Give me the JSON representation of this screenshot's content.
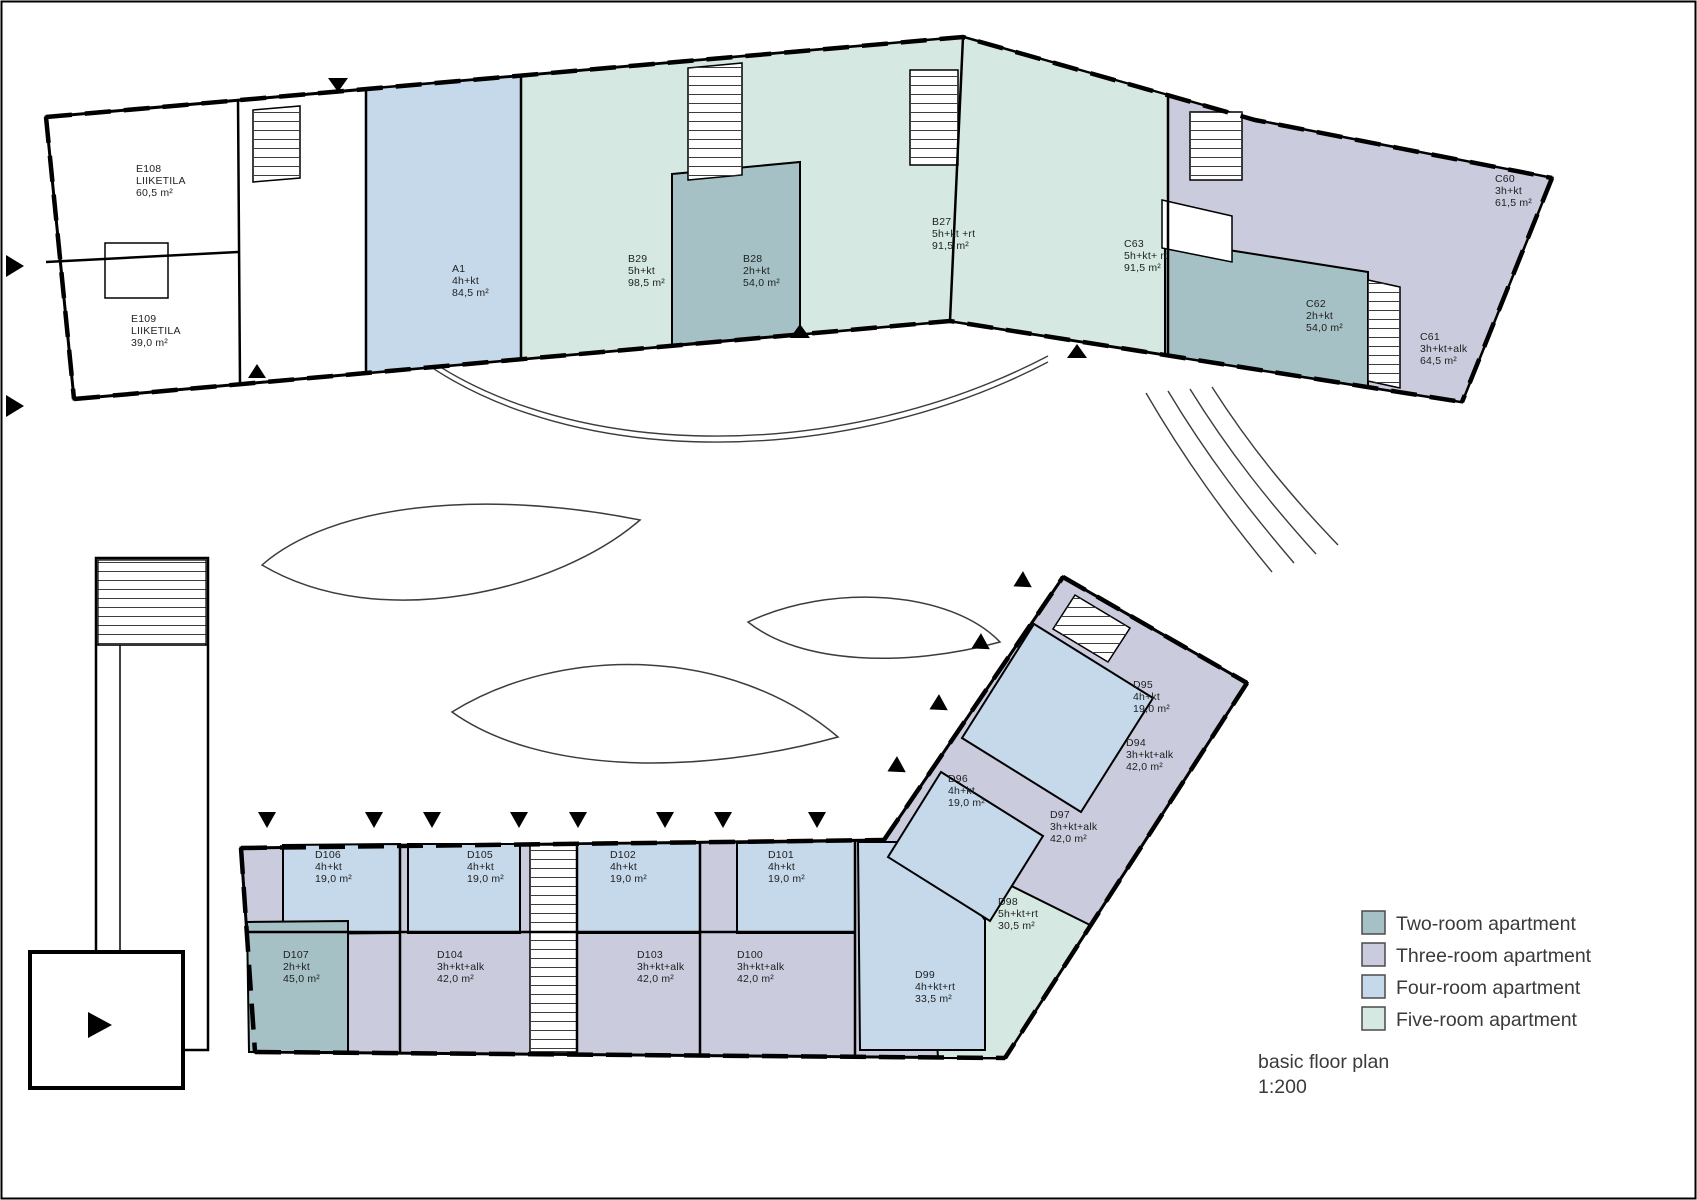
{
  "page": {
    "title_line1": "basic floor plan",
    "title_line2": "1:200"
  },
  "colors": {
    "wall": "#000000",
    "thin_line": "#3c3c3c",
    "white": "#ffffff",
    "two_room": "#a6c1c5",
    "three_room": "#cacbdc",
    "four_room": "#c5d9eb",
    "five_room": "#d5e8e2"
  },
  "legend": {
    "items": [
      {
        "label": "Two-room apartment",
        "color": "#a6c1c5"
      },
      {
        "label": "Three-room apartment",
        "color": "#cacbdc"
      },
      {
        "label": "Four-room apartment",
        "color": "#c5d9eb"
      },
      {
        "label": "Five-room apartment",
        "color": "#d5e8e2"
      }
    ]
  },
  "units": [
    {
      "id": "E108",
      "type": "LIIKETILA",
      "area": "60,5 m²",
      "category": "commercial"
    },
    {
      "id": "E109",
      "type": "LIIKETILA",
      "area": "39,0 m²",
      "category": "commercial"
    },
    {
      "id": "A1",
      "type": "4h+kt",
      "area": "84,5 m²",
      "category": "four_room"
    },
    {
      "id": "B29",
      "type": "5h+kt",
      "area": "98,5 m²",
      "category": "five_room"
    },
    {
      "id": "B28",
      "type": "2h+kt",
      "area": "54,0 m²",
      "category": "two_room"
    },
    {
      "id": "B27",
      "type": "5h+kt +rt",
      "area": "91,5 m²",
      "category": "five_room"
    },
    {
      "id": "C63",
      "type": "5h+kt+ rt",
      "area": "91,5 m²",
      "category": "five_room"
    },
    {
      "id": "C60",
      "type": "3h+kt",
      "area": "61,5 m²",
      "category": "three_room"
    },
    {
      "id": "C62",
      "type": "2h+kt",
      "area": "54,0 m²",
      "category": "two_room"
    },
    {
      "id": "C61",
      "type": "3h+kt+alk",
      "area": "64,5 m²",
      "category": "three_room"
    },
    {
      "id": "D95",
      "type": "4h+kt",
      "area": "19,0 m²",
      "category": "four_room"
    },
    {
      "id": "D94",
      "type": "3h+kt+alk",
      "area": "42,0 m²",
      "category": "three_room"
    },
    {
      "id": "D96",
      "type": "4h+kt",
      "area": "19,0 m²",
      "category": "four_room"
    },
    {
      "id": "D97",
      "type": "3h+kt+alk",
      "area": "42,0 m²",
      "category": "three_room"
    },
    {
      "id": "D98",
      "type": "5h+kt+rt",
      "area": "30,5 m²",
      "category": "five_room"
    },
    {
      "id": "D99",
      "type": "4h+kt+rt",
      "area": "33,5 m²",
      "category": "four_room"
    },
    {
      "id": "D100",
      "type": "3h+kt+alk",
      "area": "42,0 m²",
      "category": "three_room"
    },
    {
      "id": "D101",
      "type": "4h+kt",
      "area": "19,0 m²",
      "category": "four_room"
    },
    {
      "id": "D102",
      "type": "4h+kt",
      "area": "19,0 m²",
      "category": "four_room"
    },
    {
      "id": "D103",
      "type": "3h+kt+alk",
      "area": "42,0 m²",
      "category": "three_room"
    },
    {
      "id": "D104",
      "type": "3h+kt+alk",
      "area": "42,0 m²",
      "category": "three_room"
    },
    {
      "id": "D105",
      "type": "4h+kt",
      "area": "19,0 m²",
      "category": "four_room"
    },
    {
      "id": "D106",
      "type": "4h+kt",
      "area": "19,0 m²",
      "category": "four_room"
    },
    {
      "id": "D107",
      "type": "2h+kt",
      "area": "45,0 m²",
      "category": "two_room"
    }
  ]
}
